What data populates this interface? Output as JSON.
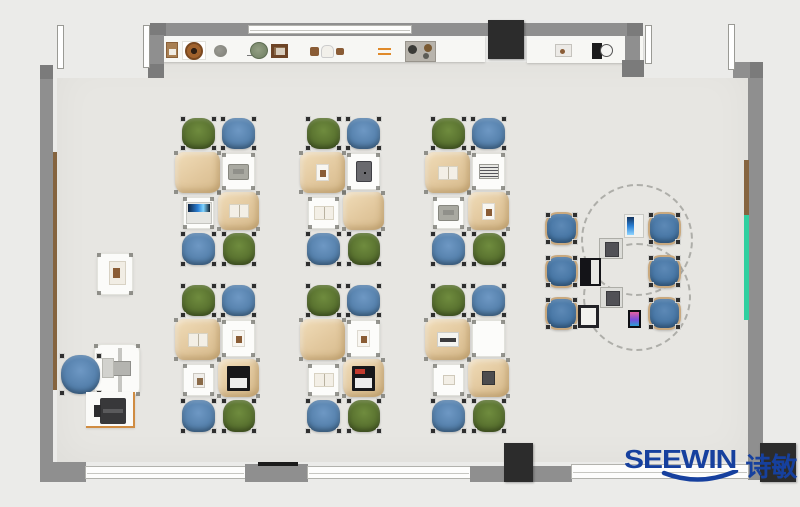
{
  "branding": {
    "logo_text": "SEEWIN",
    "logo_cjk": "诗敏",
    "logo_color": "#16409e"
  },
  "palette": {
    "outside": "#ebebe9",
    "floor": "#e7e6e2",
    "wall": "#8f8f8f",
    "wall_corner": "#7b7b7b",
    "dark_block": "#2c2c2c",
    "desk_tan": "#e2c89e",
    "desk_white": "#fcfcfa",
    "chair_green": "#5e7c31",
    "chair_blue": "#5d89b8",
    "round_chair_blue": "#4d7dac",
    "green_board": "#2fd0a0",
    "wood_strip": "#85643f",
    "stand_accent": "#d08c42"
  },
  "scene": {
    "canvas": {
      "w": 800,
      "h": 507
    },
    "structures": [
      {
        "kind": "floor",
        "rect": [
          57,
          62,
          691,
          400
        ],
        "name": "room-floor"
      },
      {
        "kind": "outside",
        "rect": [
          53,
          62,
          95,
          16
        ],
        "name": "top-left-door-opening"
      },
      {
        "kind": "outside",
        "rect": [
          643,
          62,
          90,
          16
        ],
        "name": "top-right-door-opening"
      },
      {
        "kind": "shelf",
        "rect": [
          163,
          36,
          322,
          26
        ],
        "name": "display-shelf-left"
      },
      {
        "kind": "shelf",
        "rect": [
          527,
          36,
          116,
          27
        ],
        "name": "display-shelf-right"
      },
      {
        "kind": "wall",
        "rect": [
          150,
          23,
          493,
          13
        ],
        "name": "top-wall"
      },
      {
        "kind": "window",
        "rect": [
          248,
          25,
          164,
          9
        ],
        "name": "top-wall-window"
      },
      {
        "kind": "wall-dark",
        "rect": [
          150,
          23,
          16,
          13
        ],
        "name": "top-wall-corner-left"
      },
      {
        "kind": "wall-dark",
        "rect": [
          627,
          23,
          16,
          13
        ],
        "name": "top-wall-corner-right"
      },
      {
        "kind": "wall",
        "rect": [
          148,
          35,
          16,
          43
        ],
        "name": "top-left-wall-return"
      },
      {
        "kind": "wall-dark",
        "rect": [
          148,
          64,
          16,
          14
        ],
        "name": "top-left-inner-corner"
      },
      {
        "kind": "wall",
        "rect": [
          40,
          65,
          13,
          405
        ],
        "name": "left-wall"
      },
      {
        "kind": "wall-dark",
        "rect": [
          40,
          65,
          13,
          14
        ],
        "name": "left-wall-top-corner"
      },
      {
        "kind": "strip-brown",
        "rect": [
          53,
          152,
          4,
          238
        ],
        "name": "left-wall-wood-strip"
      },
      {
        "kind": "wall",
        "rect": [
          625,
          36,
          15,
          28
        ],
        "name": "top-right-wall-return"
      },
      {
        "kind": "wall-dark",
        "rect": [
          622,
          60,
          22,
          17
        ],
        "name": "top-right-inner-corner"
      },
      {
        "kind": "wall",
        "rect": [
          733,
          62,
          30,
          16
        ],
        "name": "right-wall-top-stub"
      },
      {
        "kind": "wall-dark",
        "rect": [
          750,
          62,
          13,
          16
        ],
        "name": "right-wall-top-corner"
      },
      {
        "kind": "wall",
        "rect": [
          748,
          78,
          15,
          402
        ],
        "name": "right-wall"
      },
      {
        "kind": "strip-brown",
        "rect": [
          744,
          160,
          5,
          55
        ],
        "name": "right-wall-wood-strip"
      },
      {
        "kind": "strip-green",
        "rect": [
          744,
          215,
          5,
          105
        ],
        "name": "right-wall-green-board"
      },
      {
        "kind": "wall",
        "rect": [
          40,
          462,
          46,
          20
        ],
        "name": "bottom-left-corner"
      },
      {
        "kind": "window",
        "rect": [
          85,
          466,
          161,
          13
        ],
        "name": "bottom-window-1"
      },
      {
        "kind": "wall",
        "rect": [
          245,
          464,
          63,
          18
        ],
        "name": "bottom-wall-pier-1"
      },
      {
        "kind": "bar-black",
        "rect": [
          258,
          462,
          40,
          4
        ],
        "name": "bottom-wall-vent"
      },
      {
        "kind": "window",
        "rect": [
          307,
          466,
          164,
          13
        ],
        "name": "bottom-window-2"
      },
      {
        "kind": "wall",
        "rect": [
          470,
          466,
          102,
          16
        ],
        "name": "bottom-wall-pier-2"
      },
      {
        "kind": "window",
        "rect": [
          571,
          464,
          178,
          15
        ],
        "name": "bottom-window-3"
      },
      {
        "kind": "block-dark",
        "rect": [
          488,
          20,
          36,
          39
        ],
        "name": "top-wall-cabinet"
      },
      {
        "kind": "block-dark",
        "rect": [
          504,
          443,
          29,
          39
        ],
        "name": "bottom-wall-cabinet"
      },
      {
        "kind": "block-dark",
        "rect": [
          760,
          443,
          36,
          39
        ],
        "name": "bottom-right-column"
      },
      {
        "kind": "door-leaf",
        "rect": [
          57,
          25,
          7,
          44
        ],
        "name": "door-leaf-1"
      },
      {
        "kind": "door-leaf",
        "rect": [
          143,
          25,
          7,
          43
        ],
        "name": "door-leaf-2"
      },
      {
        "kind": "door-leaf",
        "rect": [
          645,
          25,
          7,
          39
        ],
        "name": "door-leaf-3"
      },
      {
        "kind": "door-leaf",
        "rect": [
          728,
          24,
          7,
          46
        ],
        "name": "door-leaf-4"
      }
    ],
    "shelf_items": [
      {
        "kind": "box-brown",
        "rect": [
          166,
          42,
          12,
          16
        ]
      },
      {
        "kind": "plate",
        "rect": [
          182,
          41,
          24,
          19
        ]
      },
      {
        "kind": "stone",
        "rect": [
          214,
          45,
          13,
          12
        ]
      },
      {
        "kind": "plant",
        "rect": [
          250,
          42,
          18,
          17
        ]
      },
      {
        "kind": "frame",
        "rect": [
          271,
          44,
          17,
          14
        ]
      },
      {
        "kind": "mini-brown",
        "rect": [
          310,
          47,
          9,
          9
        ]
      },
      {
        "kind": "mini-white",
        "rect": [
          321,
          45,
          13,
          13
        ]
      },
      {
        "kind": "mini-brown",
        "rect": [
          336,
          48,
          8,
          7
        ]
      },
      {
        "kind": "orange-lines",
        "rect": [
          378,
          48,
          13,
          7
        ]
      },
      {
        "kind": "tray",
        "rect": [
          405,
          41,
          31,
          21
        ]
      },
      {
        "kind": "gadget",
        "rect": [
          555,
          44,
          17,
          13
        ]
      },
      {
        "kind": "clock",
        "rect": [
          592,
          41,
          21,
          19
        ]
      }
    ],
    "clusters": {
      "cols_x": [
        175,
        300,
        425
      ],
      "rows_y": [
        118,
        285
      ],
      "size": [
        83,
        150
      ],
      "chairs": [
        {
          "pos": "tl",
          "color": "green",
          "rect": [
            7,
            0,
            33,
            31
          ]
        },
        {
          "pos": "tr",
          "color": "blue",
          "rect": [
            47,
            0,
            33,
            31
          ]
        },
        {
          "pos": "bl",
          "color": "blue",
          "rect": [
            7,
            115,
            33,
            32
          ]
        },
        {
          "pos": "br",
          "color": "green",
          "rect": [
            48,
            115,
            32,
            32
          ]
        }
      ],
      "desks": [
        {
          "pos": "tl",
          "kind": "tan",
          "rect": [
            0,
            34,
            45,
            41
          ]
        },
        {
          "pos": "tr",
          "kind": "white",
          "rect": [
            47,
            35,
            33,
            37
          ]
        },
        {
          "pos": "bl",
          "kind": "white",
          "rect": [
            8,
            79,
            31,
            32
          ]
        },
        {
          "pos": "br",
          "kind": "tan",
          "rect": [
            43,
            74,
            41,
            38
          ]
        }
      ],
      "items": [
        [
          "",
          "laptop-gray",
          "laptop-blue",
          "book"
        ],
        [
          "paper",
          "tablet",
          "book",
          ""
        ],
        [
          "book",
          "notebook",
          "laptop-gray",
          "paper"
        ],
        [
          "book",
          "paper",
          "photo",
          "laptop-screen"
        ],
        [
          "",
          "paper",
          "book",
          "laptop-screen-red"
        ],
        [
          "typewriter",
          "",
          "book-small",
          "device"
        ]
      ]
    },
    "teacher": {
      "wall_shelf": [
        97,
        253,
        36,
        42
      ],
      "shelf_item": [
        109,
        261,
        17,
        24
      ],
      "desk": [
        94,
        344,
        46,
        52
      ],
      "monitor_bar": [
        118,
        348,
        4,
        44
      ],
      "monitor": [
        111,
        361,
        20,
        15
      ],
      "pad": [
        102,
        358,
        12,
        20
      ],
      "chair": [
        61,
        355,
        39,
        39
      ],
      "printer_stand": [
        86,
        392,
        49,
        36
      ],
      "printer": [
        100,
        398,
        26,
        26
      ]
    },
    "round_group": {
      "circles": [
        [
          581,
          184,
          112,
          112
        ],
        [
          583,
          243,
          108,
          108
        ]
      ],
      "chair_size": [
        33,
        33
      ],
      "chairs": [
        [
          545,
          212
        ],
        [
          545,
          255
        ],
        [
          545,
          297
        ],
        [
          648,
          212
        ],
        [
          648,
          255
        ],
        [
          648,
          297
        ]
      ],
      "devices": [
        {
          "kind": "rd-tablet",
          "rect": [
            624,
            214,
            20,
            24
          ]
        },
        {
          "kind": "rd-console",
          "rect": [
            599,
            238,
            24,
            21
          ]
        },
        {
          "kind": "rd-laptop-dark",
          "rect": [
            580,
            258,
            21,
            28
          ]
        },
        {
          "kind": "rd-console",
          "rect": [
            600,
            287,
            23,
            21
          ]
        },
        {
          "kind": "rd-laptop-white",
          "rect": [
            578,
            305,
            21,
            23
          ]
        },
        {
          "kind": "rd-phone",
          "rect": [
            628,
            310,
            13,
            18
          ]
        }
      ]
    }
  }
}
